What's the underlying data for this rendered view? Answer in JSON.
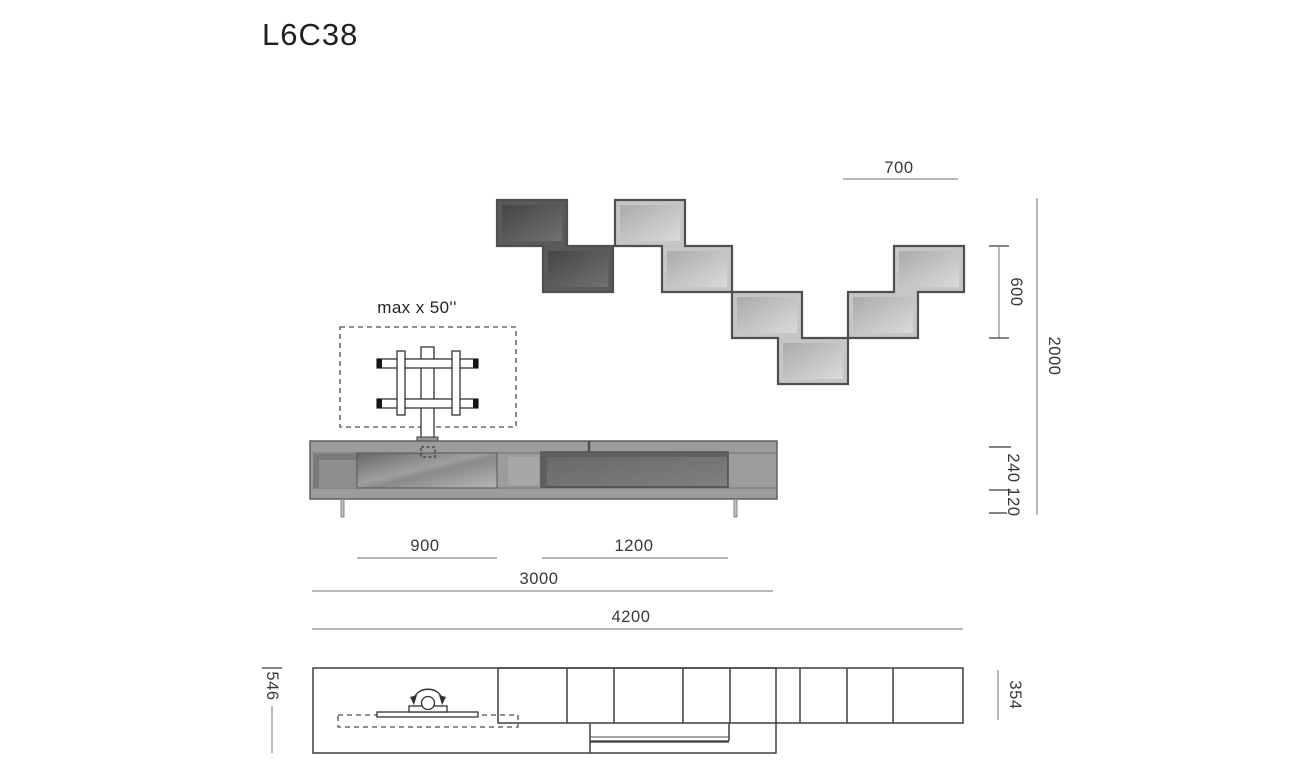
{
  "title": "L6C38",
  "tv_note": "max x 50''",
  "dims": {
    "d700": "700",
    "d600": "600",
    "d2000": "2000",
    "d240": "240",
    "d120": "120",
    "d900": "900",
    "d1200": "1200",
    "d3000": "3000",
    "d4200": "4200",
    "d546": "546",
    "d354": "354"
  },
  "colors": {
    "module_dark": "#5a5a5a",
    "module_light": "#c6c6c6",
    "module_outline": "#4f4f4f",
    "cabinet_body": "#9c9c9c",
    "cabinet_panel_dark": "#7a7a7a",
    "dim_line": "#8a8a8a",
    "text": "#2d2d2d"
  }
}
